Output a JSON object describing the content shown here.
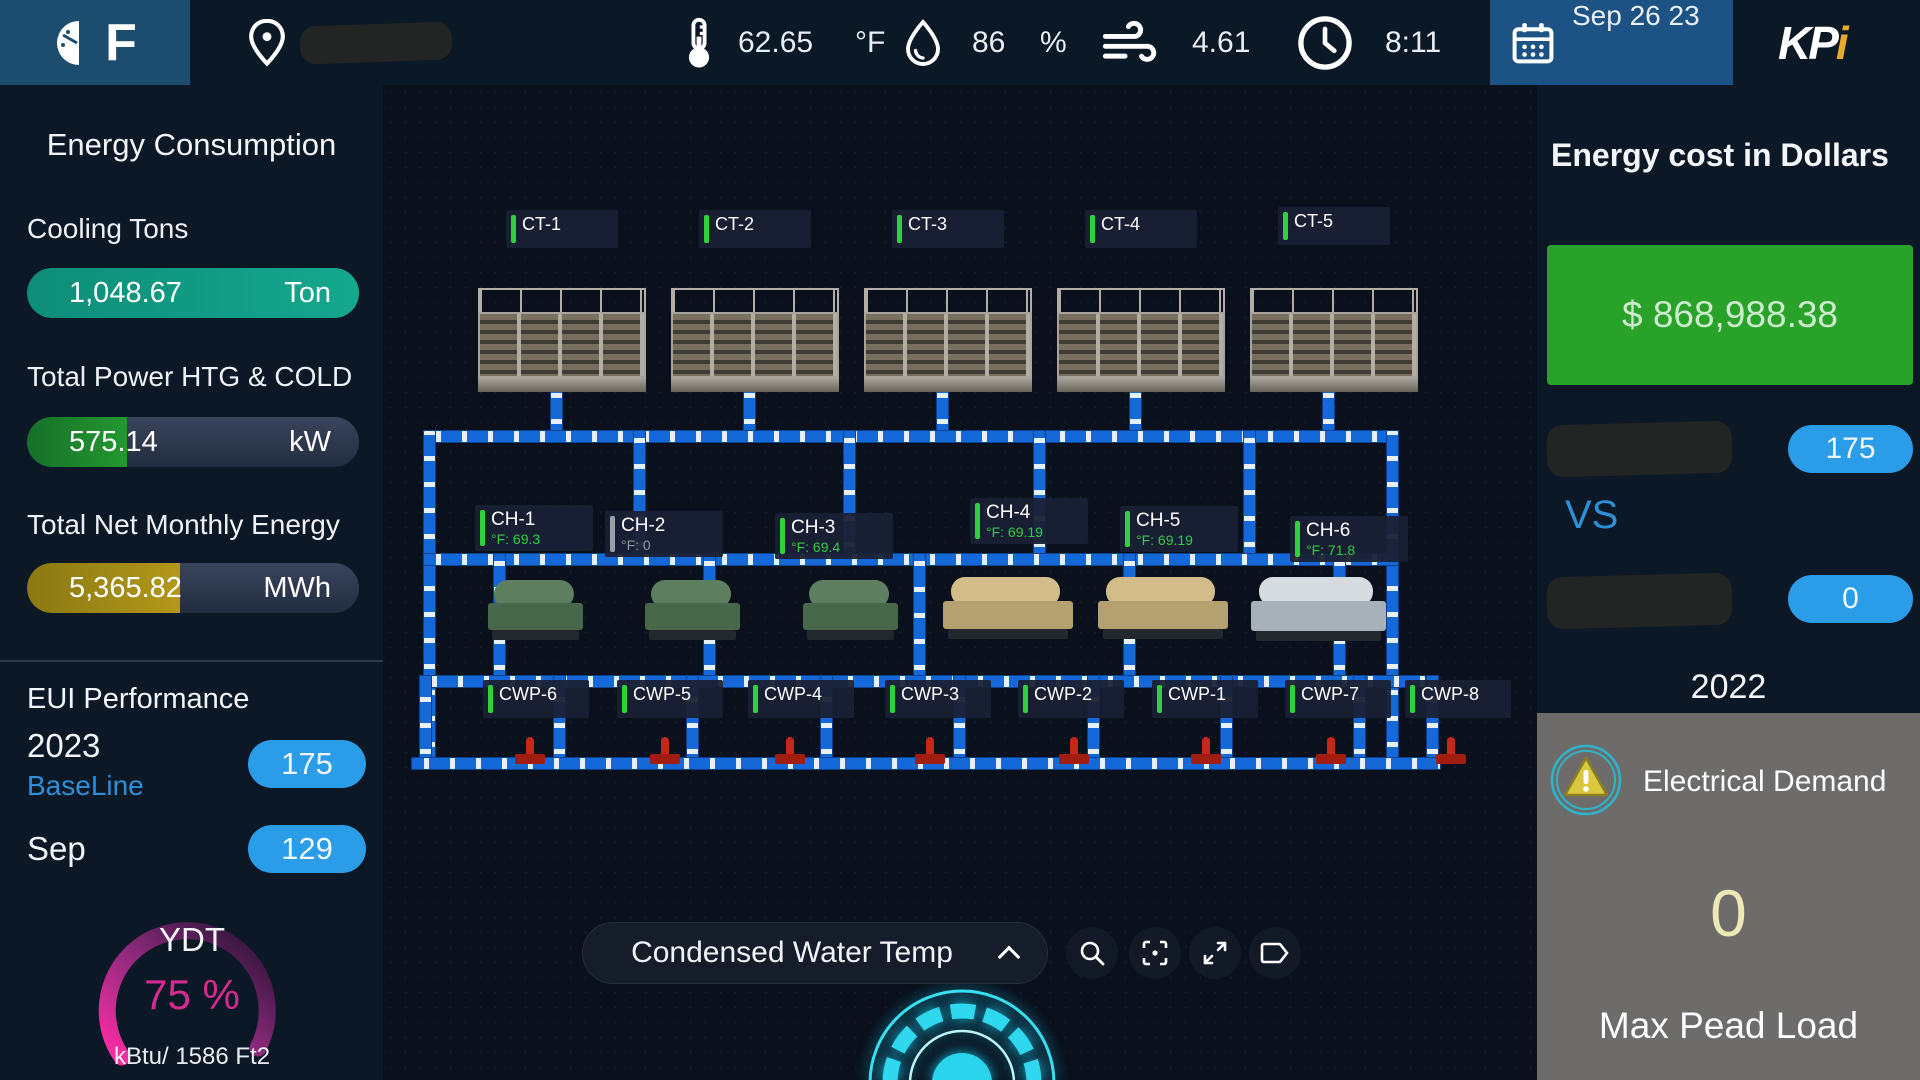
{
  "topbar": {
    "logo_letter": "F",
    "temp_value": "62.65",
    "temp_unit": "°F",
    "humidity_value": "86",
    "humidity_unit": "%",
    "wind_value": "4.61",
    "time": "8:11",
    "date": "Sep 26 23",
    "brand_kp": "KP",
    "brand_i": "i"
  },
  "sidebar": {
    "title": "Energy Consumption",
    "metrics": [
      {
        "label": "Cooling Tons",
        "value": "1,048.67",
        "unit": "Ton",
        "fill_pct": "100%",
        "fill_color": "#14a88d"
      },
      {
        "label": "Total Power HTG & COLD",
        "value": "575.14",
        "unit": "kW",
        "fill_pct": "30%",
        "fill_color": "#23982f"
      },
      {
        "label": "Total Net Monthly Energy",
        "value": "5,365.82",
        "unit": "MWh",
        "fill_pct": "46%",
        "fill_color": "#b2981a"
      }
    ],
    "eui": {
      "title": "EUI Performance",
      "rows": [
        {
          "year": "2023",
          "sub": "BaseLine",
          "badge": "175"
        },
        {
          "year": "Sep",
          "sub": "",
          "badge": "129"
        }
      ],
      "gauge": {
        "label": "YDT",
        "value": "75 %",
        "caption": "kBtu/ 1586 Ft2",
        "percent": 75,
        "accent": "#d62a90"
      }
    }
  },
  "diagram": {
    "cooling_towers": [
      {
        "name": "CT-1"
      },
      {
        "name": "CT-2"
      },
      {
        "name": "CT-3"
      },
      {
        "name": "CT-4"
      },
      {
        "name": "CT-5"
      }
    ],
    "chillers": [
      {
        "name": "CH-1",
        "temp": "°F: 69.3",
        "status": "on"
      },
      {
        "name": "CH-2",
        "temp": "°F: 0",
        "status": "off"
      },
      {
        "name": "CH-3",
        "temp": "°F: 69.4",
        "status": "on"
      },
      {
        "name": "CH-4",
        "temp": "°F: 69.19",
        "status": "on"
      },
      {
        "name": "CH-5",
        "temp": "°F: 69.19",
        "status": "on"
      },
      {
        "name": "CH-6",
        "temp": "°F: 71.8",
        "status": "on"
      }
    ],
    "pumps": [
      {
        "name": "CWP-6"
      },
      {
        "name": "CWP-5"
      },
      {
        "name": "CWP-4"
      },
      {
        "name": "CWP-3"
      },
      {
        "name": "CWP-2"
      },
      {
        "name": "CWP-1"
      },
      {
        "name": "CWP-7"
      },
      {
        "name": "CWP-8"
      }
    ],
    "selector_label": "Condensed Water Temp",
    "pipe_color": "#1468d8"
  },
  "right_panel": {
    "title": "Energy cost in Dollars",
    "cost": "$ 868,988.38",
    "cost_bg": "#28a228",
    "compare": {
      "badge_top": "175",
      "vs": "VS",
      "badge_bottom": "0"
    },
    "year": "2022",
    "demand": {
      "label": "Electrical Demand",
      "value": "0",
      "caption": "Max Pead Load"
    }
  }
}
